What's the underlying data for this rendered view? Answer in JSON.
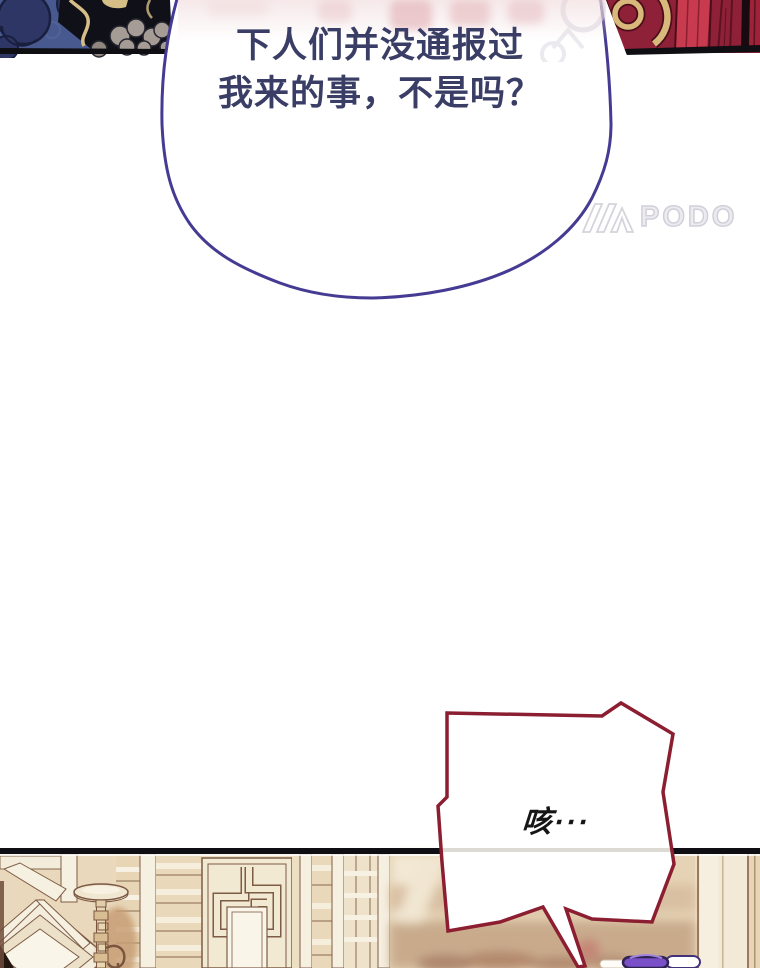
{
  "page": {
    "type": "webtoon-panel",
    "background": "#ffffff"
  },
  "dialogue": {
    "main_bubble": {
      "line1": "下人们并没通报过",
      "line2": "我来的事，不是吗？",
      "text_color": "#3a3e66",
      "outline_color": "#453b92"
    },
    "cough_bubble": {
      "text": "咳···",
      "text_color": "#161616",
      "outline_color": "#8c1e31"
    }
  },
  "watermark": {
    "icon": "podo-logo-icon",
    "text": "PODO",
    "color": "#d0cdd8"
  },
  "artwork": {
    "top_left_fragment": {
      "name": "blue-patterned-robe",
      "base_color": "#47598e",
      "accent_gold": "#d5bf86"
    },
    "top_right_fragment": {
      "name": "red-robe-gold-ring",
      "base_color": "#8e2137",
      "accent_gold": "#d8b87b"
    },
    "bottom_scene": {
      "name": "chinese-interior",
      "base_color": "#ecdcc2",
      "border_color": "#0e0e13",
      "elements": [
        "lattice-window",
        "floor-lamp",
        "fretwork-panel",
        "blurred-background",
        "purple-hair-ornament"
      ]
    }
  }
}
